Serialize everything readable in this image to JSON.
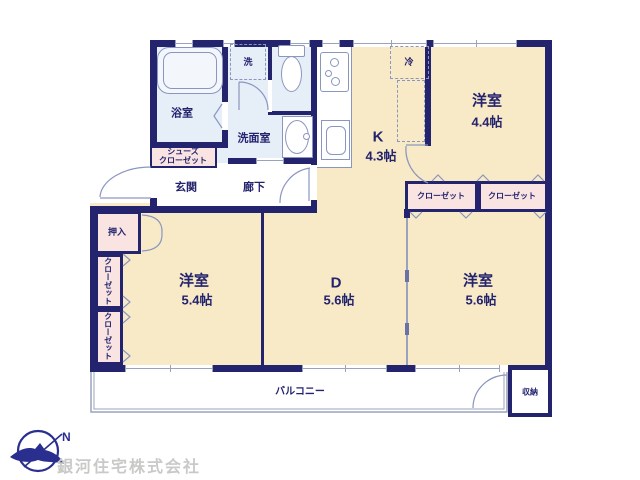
{
  "branding": {
    "compass_north": "N",
    "company_name": "銀河住宅株式会社"
  },
  "colors": {
    "wall_navy": "#23236e",
    "room_cream": "#f8eac6",
    "closet_pink": "#f9e4e2",
    "wet_area_blue": "#e6eef8",
    "fixture_outline": "#8a96c0",
    "company_text_gray": "#c9c9c7"
  },
  "rooms": {
    "bath": {
      "name": "浴室"
    },
    "washroom": {
      "name": "洗面室"
    },
    "laundry_space": {
      "name": "洗"
    },
    "shoes_closet": {
      "line1": "シューズ",
      "line2": "クローゼット"
    },
    "entrance": {
      "name": "玄関"
    },
    "hallway": {
      "name": "廊下"
    },
    "kitchen": {
      "name": "K",
      "size": "4.3帖"
    },
    "refrigerator_space": {
      "name": "冷"
    },
    "bedroom_ne": {
      "name": "洋室",
      "size": "4.4帖"
    },
    "closet_ne_left": {
      "name": "クローゼット"
    },
    "closet_ne_right": {
      "name": "クローゼット"
    },
    "bedroom_sw": {
      "name": "洋室",
      "size": "5.4帖"
    },
    "dining": {
      "name": "D",
      "size": "5.6帖"
    },
    "bedroom_se": {
      "name": "洋室",
      "size": "5.6帖"
    },
    "oshiire": {
      "name": "押入"
    },
    "closet_w_upper": {
      "name": "クローゼット"
    },
    "closet_w_lower": {
      "name": "クローゼット"
    },
    "balcony": {
      "name": "バルコニー"
    },
    "storage": {
      "name": "収納"
    }
  }
}
